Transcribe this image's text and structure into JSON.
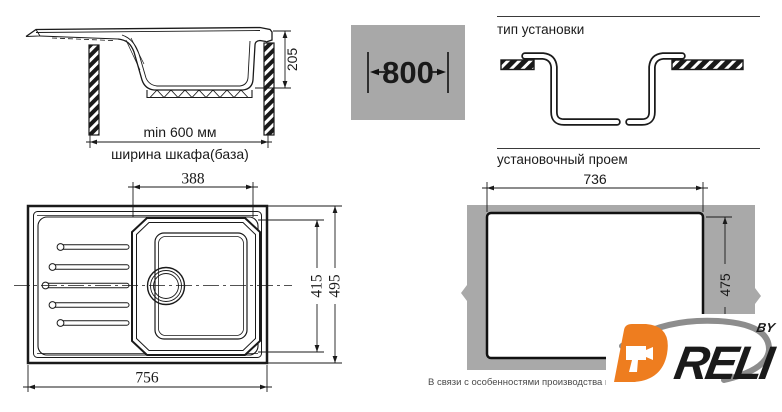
{
  "side_view": {
    "depth_dim": "205",
    "cabinet_min_width": "min 600 мм",
    "cabinet_label": "ширина шкафа(база)"
  },
  "cabinet_size_badge": {
    "value": "800"
  },
  "installation_type": {
    "title": "тип установки"
  },
  "mounting_opening": {
    "title": "установочный проем",
    "width_dim": "736",
    "height_dim": "475"
  },
  "top_view": {
    "bowl_width_dim": "388",
    "bowl_depth_dim": "415",
    "overall_depth_dim": "495",
    "overall_width_dim": "756"
  },
  "logo": {
    "brand": "DRELI",
    "brand_letter_d": "D",
    "brand_rest": "RELI",
    "byline": "BY"
  },
  "footnote": "В связи с особенностями производства вырез в с",
  "colors": {
    "accent_orange": "#ee7d1f",
    "swoosh_gray": "#8d8d8d",
    "slab_gray": "#a9a9a9",
    "badge_gray": "#a8a8a8",
    "line": "#1a1a1a"
  }
}
